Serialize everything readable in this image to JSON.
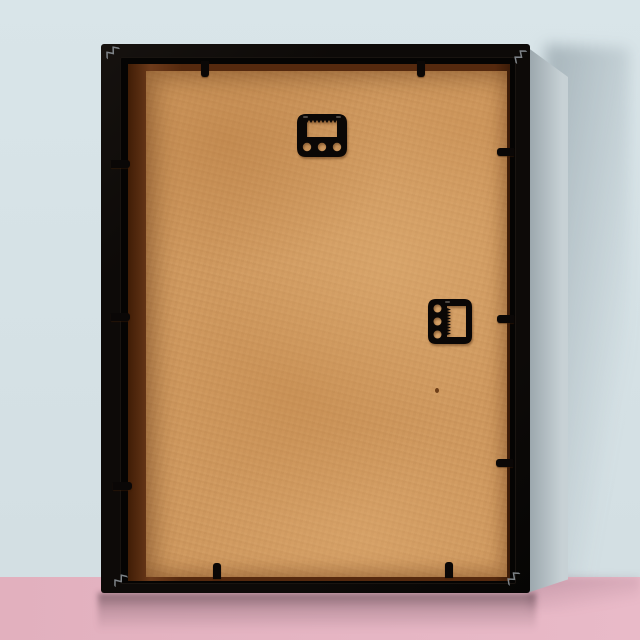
{
  "meta": {
    "domain": "product-photo",
    "subject": "Rear view of a black wooden picture frame with a tan MDF backing board, leaning against a pale blue wall on a pink glossy floor"
  },
  "colors": {
    "wall_top": "#d9e5e9",
    "wall_bottom": "#d3dfe3",
    "floor_left": "#e2b0be",
    "floor_right": "#e9bac8",
    "frame": "#0d0a08",
    "side_dark": "#98a4aa",
    "side_light": "#c7d1d5",
    "rabbet": "#55290e",
    "rabbet_hi": "#6d3a1a",
    "board": "#d09a60",
    "hardware": "#0a0706",
    "staple": "#8b9196"
  },
  "objects": {
    "frame": {
      "label": "black picture frame, rear view"
    },
    "frame_side": {
      "label": "grey side of frame box showing depth"
    },
    "backing_board": {
      "label": "tan MDF backing board with mottled wood-fibre texture"
    },
    "rabbet_border": {
      "label": "dark brown recess border around backing board"
    },
    "hangers": [
      {
        "label": "sawtooth hanger, top centre (portrait hanging)",
        "orientation": "horizontal",
        "holes": 3
      },
      {
        "label": "sawtooth hanger, right middle (landscape hanging)",
        "orientation": "vertical",
        "holes": 3
      }
    ],
    "flexi_tabs": {
      "label": "black flexi-tab clips holding the board",
      "count": 10
    },
    "corner_vnails": {
      "label": "metal v-nail fasteners in frame corners",
      "count": 4
    },
    "floor_reflection": {
      "label": "soft reflection of frame on glossy pink floor"
    },
    "wall_shadow": {
      "label": "soft cast shadow on wall to the right of frame"
    }
  }
}
